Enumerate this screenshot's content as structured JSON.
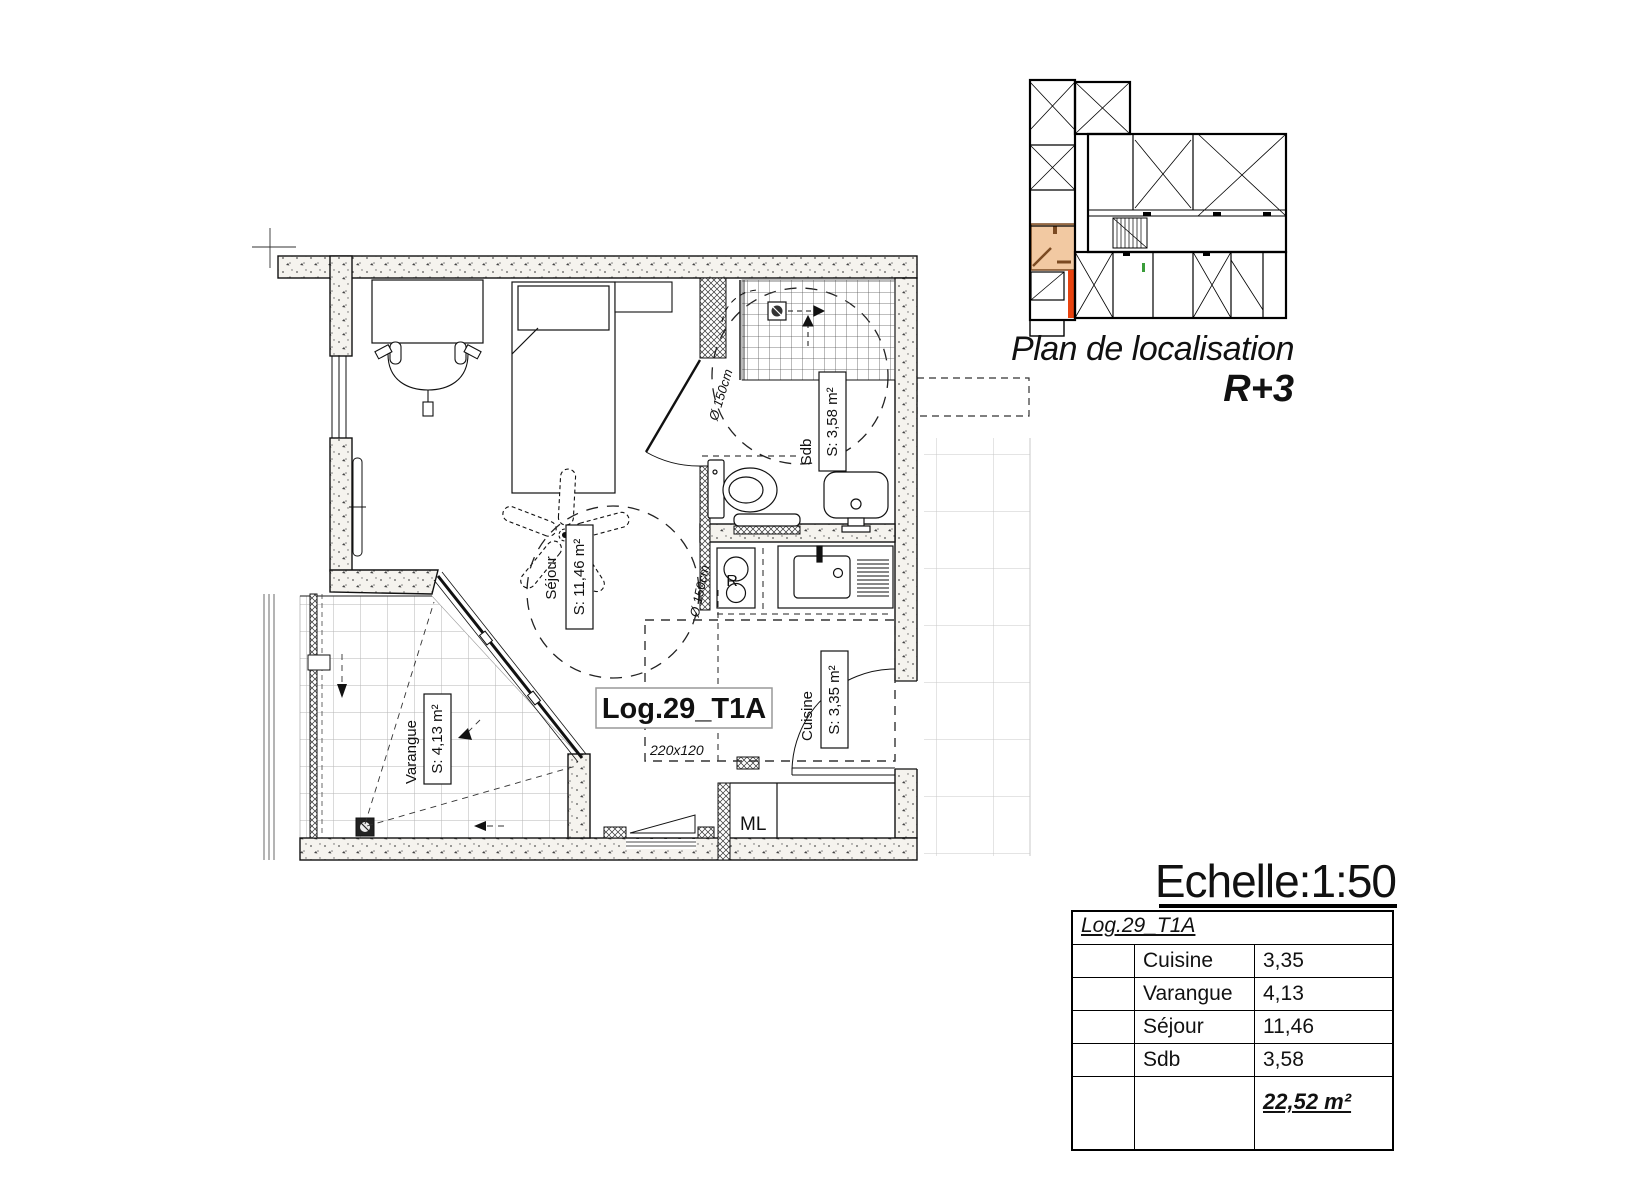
{
  "colors": {
    "accent_orange": "#E8430F",
    "highlight_fill": "#F2C9A2",
    "highlight_wall": "#7B4A22",
    "line": "#1a1a1a"
  },
  "floor_plan": {
    "unit_label": "Log.29_T1A",
    "zone_dimension": "220x120",
    "sejour": {
      "name": "Séjour",
      "area": "S: 11,46 m²"
    },
    "varangue": {
      "name": "Varangue",
      "area": "S: 4,13 m²"
    },
    "cuisine": {
      "name": "Cuisine",
      "area": "S: 3,35 m²"
    },
    "sdb": {
      "name": "Sdb",
      "area": "S: 3,58 m²"
    },
    "diameter_label": "Ø 150cm",
    "fridge_label": "R",
    "washing_machine_label": "ML"
  },
  "localisation": {
    "title": "Plan de localisation",
    "level": "R+3"
  },
  "scale_label": "Echelle:1:50",
  "area_table": {
    "header": "Log.29_T1A",
    "rows": [
      {
        "label": "Cuisine",
        "value": "3,35"
      },
      {
        "label": "Varangue",
        "value": "4,13"
      },
      {
        "label": "Séjour",
        "value": "11,46"
      },
      {
        "label": "Sdb",
        "value": "3,58"
      }
    ],
    "total": "22,52 m²"
  }
}
